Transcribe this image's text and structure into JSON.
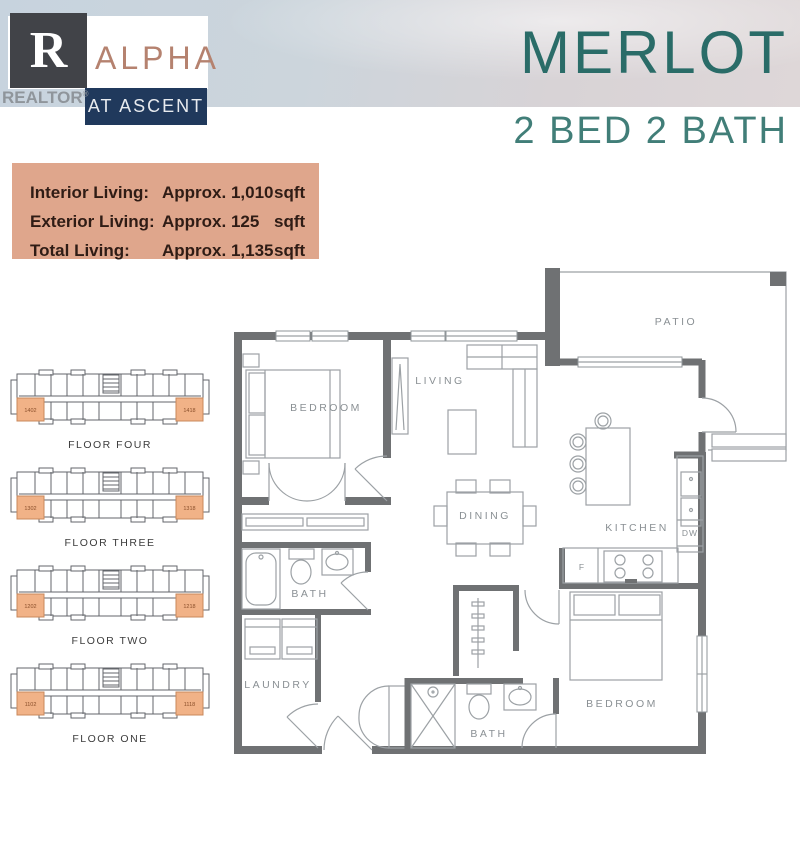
{
  "header": {
    "brand": "ALPHA",
    "brand_sub": "AT ASCENT",
    "watermark_letter": "R",
    "watermark_text": "REALTOR",
    "registered": "®",
    "title": "MERLOT",
    "subtitle": "2 BED 2 BATH"
  },
  "summary": {
    "rows": [
      {
        "label": "Interior Living:",
        "value": "Approx. 1,010",
        "unit": "sqft"
      },
      {
        "label": "Exterior Living:",
        "value": "Approx. 125",
        "unit": "sqft"
      },
      {
        "label": "Total Living:",
        "value": "Approx. 1,135",
        "unit": "sqft"
      }
    ]
  },
  "keyplans": [
    {
      "label": "FLOOR FOUR",
      "left_unit": "1402",
      "right_unit": "1418"
    },
    {
      "label": "FLOOR THREE",
      "left_unit": "1302",
      "right_unit": "1318"
    },
    {
      "label": "FLOOR TWO",
      "left_unit": "1202",
      "right_unit": "1218"
    },
    {
      "label": "FLOOR ONE",
      "left_unit": "1102",
      "right_unit": "1118"
    }
  ],
  "floorplan": {
    "rooms": {
      "bedroom1": "BEDROOM",
      "living": "LIVING",
      "dining": "DINING",
      "kitchen": "KITCHEN",
      "bath1": "BATH",
      "laundry": "LAUNDRY",
      "bath2": "BATH",
      "bedroom2": "BEDROOM",
      "patio": "PATIO"
    },
    "appliances": {
      "dishwasher": "DW",
      "fridge": "F"
    }
  },
  "colors": {
    "accent_teal": "#2a6c68",
    "subtitle_teal": "#417e78",
    "summary_salmon": "#dfa68c",
    "logo_navy": "#20395c",
    "logo_copper": "#b5826f",
    "unit_highlight": "#f1b287",
    "wall_grey": "#6f7173"
  }
}
